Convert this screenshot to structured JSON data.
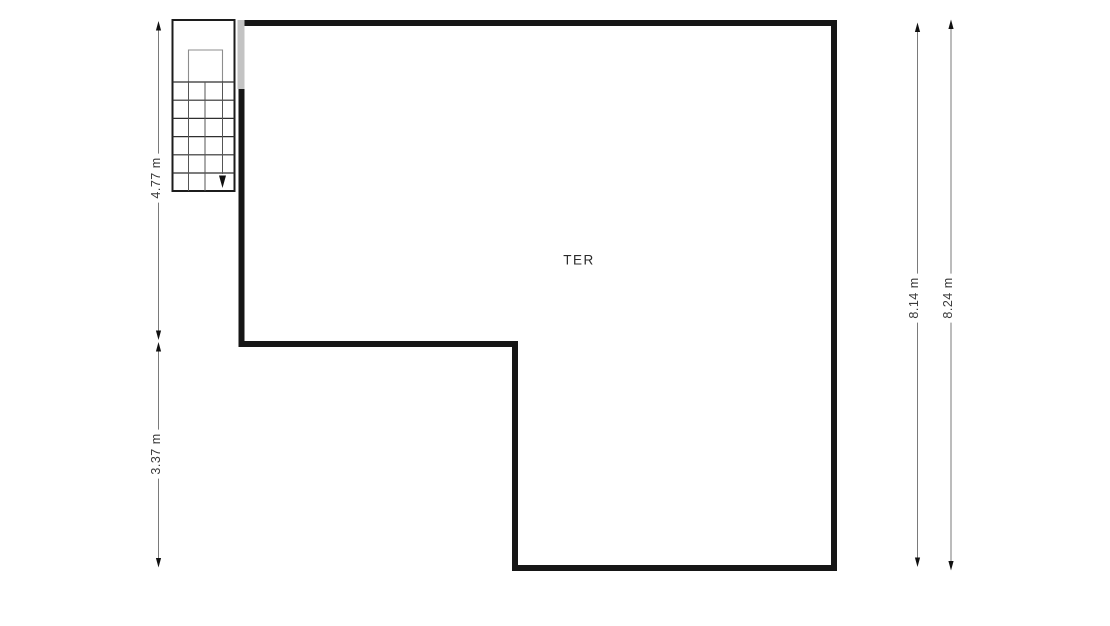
{
  "floorplan": {
    "room": {
      "label": "TER"
    },
    "dimensions": {
      "left_upper": {
        "label": "4.77 m"
      },
      "left_lower": {
        "label": "3.37 m"
      },
      "right_inner": {
        "label": "8.14 m"
      },
      "right_outer": {
        "label": "8.24 m"
      }
    },
    "icons": {
      "stair_direction_arrow": "stair-direction-arrow"
    },
    "colors": {
      "background": "#ffffff",
      "wall": "#161616",
      "door_opening": "#c3c3c3",
      "dimension_line": "#7a7a7a",
      "arrowhead": "#111111",
      "dimension_text": "#3a3a3a",
      "room_text": "#2b2b2b",
      "stair_outline": "#1c1c1c",
      "stair_tread": "#2f2f2f",
      "stair_guide": "#8d8d8d"
    }
  }
}
